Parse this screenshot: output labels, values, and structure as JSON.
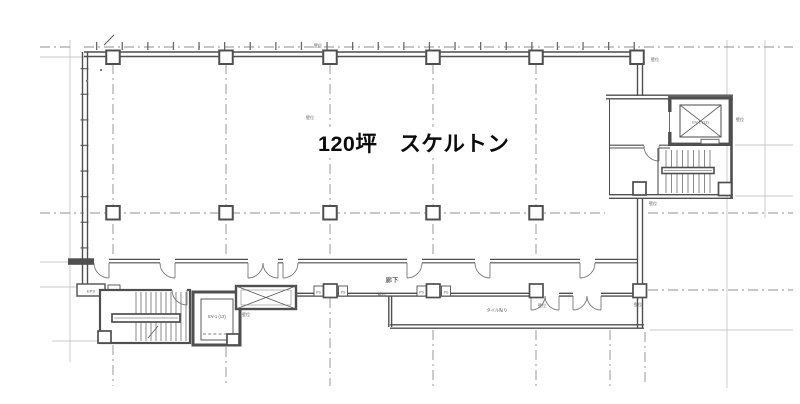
{
  "drawing": {
    "title": "floor-plan",
    "area_label": "120坪　スケルトン",
    "corridor_label": "廊下",
    "corridor_note": "タイル貼り",
    "ev_top_label": "EV-2 (11)",
    "ev_bottom_label": "EV-1 (13)",
    "ps_label": "PS",
    "eps_label": "EPS",
    "wall_marker": "壁位",
    "colors": {
      "wall": "#4f4f4f",
      "thin_line": "#b5b5b5",
      "dash_line": "#919191",
      "ink": "#0b0b0b"
    }
  }
}
